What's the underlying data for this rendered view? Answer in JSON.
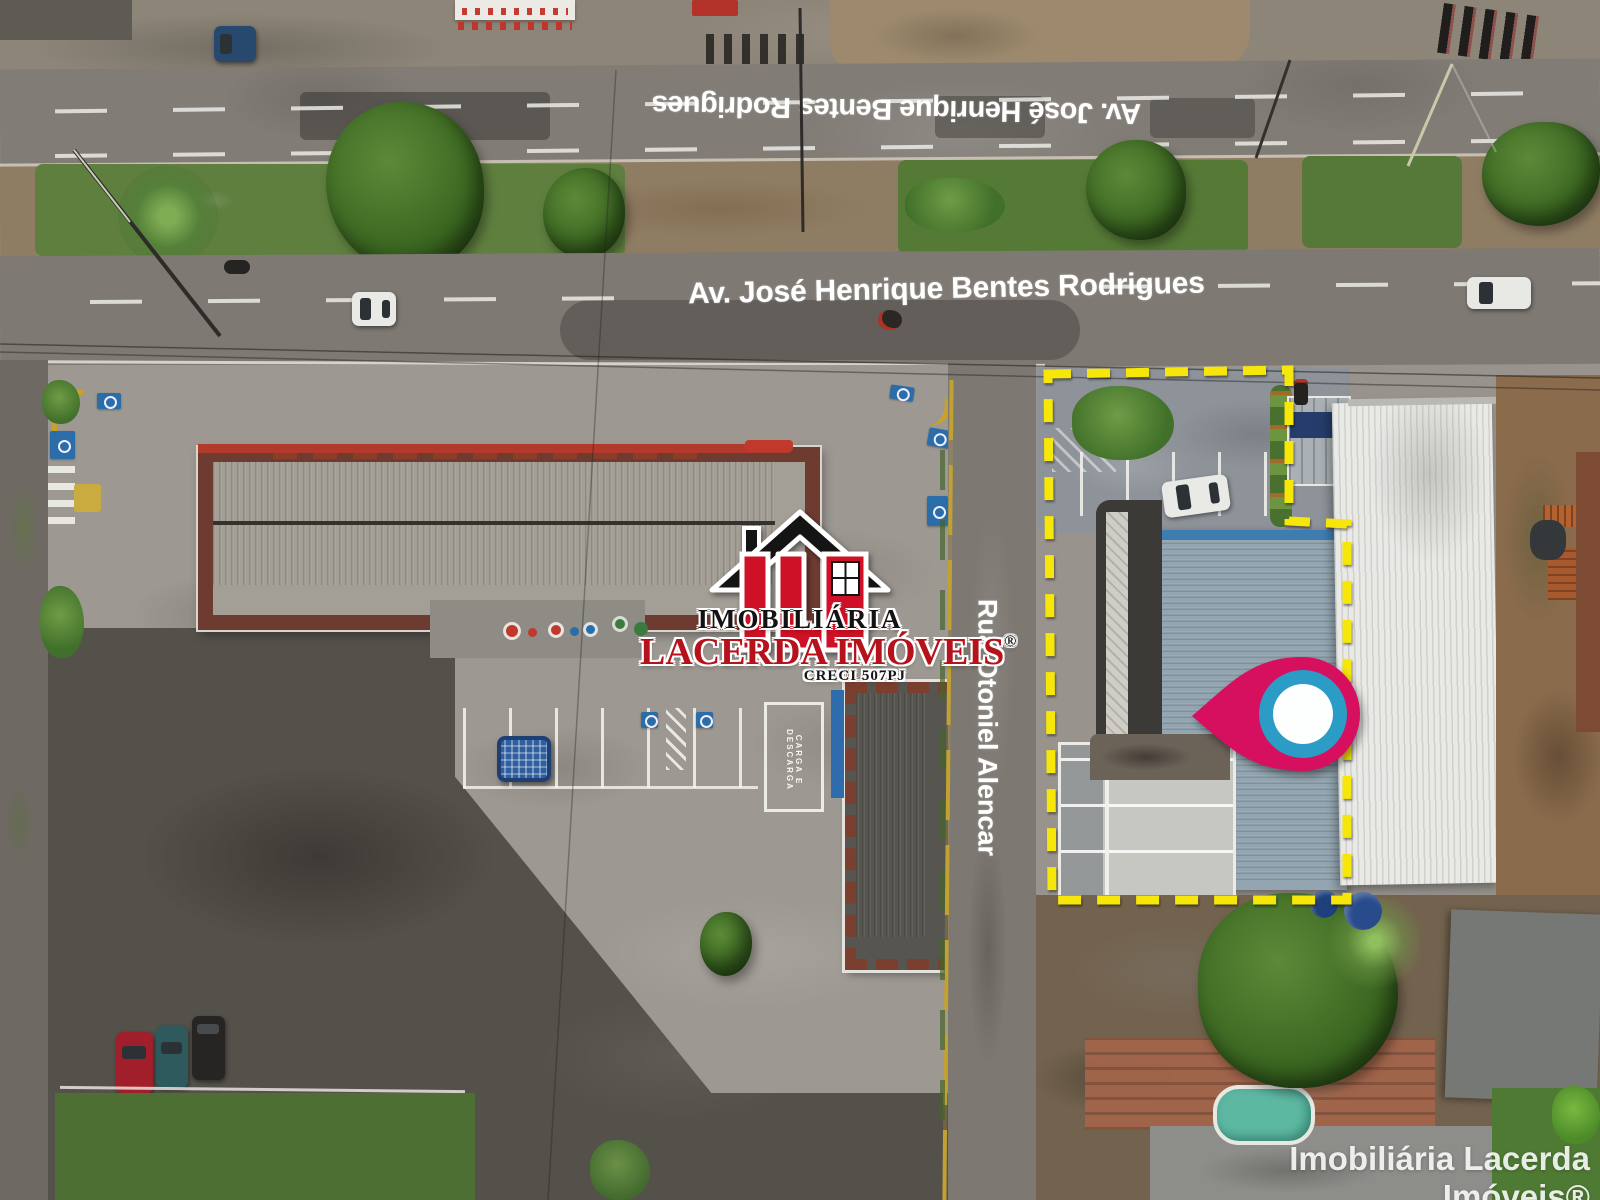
{
  "labels": {
    "avenue_top": "Av. José Henrique Bentes Rodrigues",
    "avenue_main": "Av. José Henrique Bentes Rodrigues",
    "cross_street": "Rua Otoniel Alencar",
    "loading_zone": "CARGA E DESCARGA"
  },
  "logo": {
    "monogram": "ILI",
    "line1": "IMOBILIÁRIA",
    "line2": "LACERDA IMÓVEIS",
    "registered_mark": "®",
    "creci": "CRECI 507PJ"
  },
  "watermark": "Imobiliária Lacerda Imóveis®",
  "colors": {
    "highlight_yellow": "#F6E60A",
    "pin_pink": "#D60F5F",
    "pin_ring_blue": "#2B9CC6",
    "logo_red": "#B5121B"
  }
}
